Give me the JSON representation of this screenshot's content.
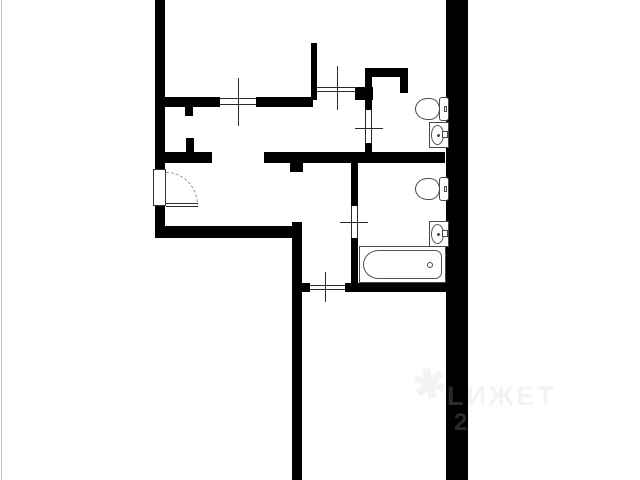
{
  "image": {
    "width": 640,
    "height": 480,
    "background": "#ffffff",
    "edge_line_color": "#c9c9c9"
  },
  "floorplan": {
    "wall_color": "#000000",
    "thin_line_color": "#2a2a2a",
    "fixture_outline_color": "#4a4a4a",
    "walls": [
      {
        "name": "left-wall-upper",
        "x": 155,
        "y": 0,
        "w": 10,
        "h": 170
      },
      {
        "name": "left-wall-lower",
        "x": 155,
        "y": 206,
        "w": 10,
        "h": 32
      },
      {
        "name": "living-room-bottom-wall",
        "x": 155,
        "y": 226,
        "w": 147,
        "h": 12
      },
      {
        "name": "corridor-wall",
        "x": 292,
        "y": 222,
        "w": 10,
        "h": 258
      },
      {
        "name": "corridor-wall-right-stub",
        "x": 302,
        "y": 283,
        "w": 8,
        "h": 9
      },
      {
        "name": "hall-wall-left-segment",
        "x": 165,
        "y": 152,
        "w": 47,
        "h": 11
      },
      {
        "name": "hall-wall-up-stub",
        "x": 186,
        "y": 138,
        "w": 8,
        "h": 14
      },
      {
        "name": "hall-wall-right-segment",
        "x": 264,
        "y": 152,
        "w": 181,
        "h": 11
      },
      {
        "name": "hall-wall-down-stub",
        "x": 290,
        "y": 163,
        "w": 13,
        "h": 9
      },
      {
        "name": "top-window-wall-left",
        "x": 165,
        "y": 97,
        "w": 55,
        "h": 10
      },
      {
        "name": "top-window-wall-right",
        "x": 256,
        "y": 97,
        "w": 57,
        "h": 10
      },
      {
        "name": "top-wall-down-stub",
        "x": 185,
        "y": 107,
        "w": 8,
        "h": 9
      },
      {
        "name": "upper-room-partition",
        "x": 311,
        "y": 43,
        "w": 6,
        "h": 57
      },
      {
        "name": "wc-corner-chunk",
        "x": 355,
        "y": 87,
        "w": 18,
        "h": 13
      },
      {
        "name": "wc-left-wall-upper",
        "x": 365,
        "y": 68,
        "w": 7,
        "h": 42
      },
      {
        "name": "wc-left-wall-lower",
        "x": 365,
        "y": 143,
        "w": 7,
        "h": 12
      },
      {
        "name": "wc-top-wall",
        "x": 365,
        "y": 68,
        "w": 43,
        "h": 9
      },
      {
        "name": "wc-duct-stub",
        "x": 400,
        "y": 77,
        "w": 8,
        "h": 16
      },
      {
        "name": "right-outer-wall",
        "x": 446,
        "y": 0,
        "w": 22,
        "h": 480
      },
      {
        "name": "bathroom-left-wall-upper",
        "x": 351,
        "y": 163,
        "w": 7,
        "h": 43
      },
      {
        "name": "bathroom-left-wall-lower",
        "x": 351,
        "y": 238,
        "w": 7,
        "h": 45
      },
      {
        "name": "bathroom-bottom-wall",
        "x": 345,
        "y": 283,
        "w": 101,
        "h": 9
      }
    ],
    "thin_lines": [
      {
        "name": "top-window-line-1",
        "x": 220,
        "y": 98,
        "w": 36,
        "h": 1
      },
      {
        "name": "top-window-line-2",
        "x": 220,
        "y": 104,
        "w": 36,
        "h": 1
      },
      {
        "name": "top-window-tick",
        "x": 238,
        "y": 78,
        "w": 1,
        "h": 48
      },
      {
        "name": "inner-window-line-1",
        "x": 317,
        "y": 87,
        "w": 40,
        "h": 1
      },
      {
        "name": "inner-window-line-2",
        "x": 317,
        "y": 91,
        "w": 40,
        "h": 1
      },
      {
        "name": "inner-window-tick",
        "x": 337,
        "y": 66,
        "w": 1,
        "h": 44
      },
      {
        "name": "wc-door-line-1",
        "x": 365,
        "y": 110,
        "w": 1,
        "h": 33
      },
      {
        "name": "wc-door-line-2",
        "x": 371,
        "y": 110,
        "w": 1,
        "h": 33
      },
      {
        "name": "wc-door-tick",
        "x": 355,
        "y": 128,
        "w": 28,
        "h": 1
      },
      {
        "name": "bathroom-door-line-1",
        "x": 351,
        "y": 206,
        "w": 1,
        "h": 32
      },
      {
        "name": "bathroom-door-line-2",
        "x": 357,
        "y": 206,
        "w": 1,
        "h": 32
      },
      {
        "name": "bathroom-door-tick",
        "x": 340,
        "y": 222,
        "w": 28,
        "h": 1
      },
      {
        "name": "bedroom-opening-line-1",
        "x": 310,
        "y": 285,
        "w": 35,
        "h": 1
      },
      {
        "name": "bedroom-opening-line-2",
        "x": 310,
        "y": 289,
        "w": 35,
        "h": 1
      },
      {
        "name": "bedroom-opening-tick",
        "x": 325,
        "y": 272,
        "w": 1,
        "h": 30
      },
      {
        "name": "entry-threshold-line-1",
        "x": 166,
        "y": 203,
        "w": 32,
        "h": 1
      },
      {
        "name": "entry-threshold-line-2",
        "x": 166,
        "y": 206,
        "w": 32,
        "h": 1
      }
    ],
    "entry_door": {
      "leaf": {
        "name": "entry-door-leaf",
        "x": 153,
        "y": 169,
        "w": 13,
        "h": 37
      },
      "arc": {
        "name": "entry-door-arc",
        "x": 166,
        "y": 172,
        "w": 32,
        "h": 33
      }
    },
    "fixtures": [
      {
        "type": "toilet",
        "name": "toilet-upper-bathroom",
        "x": 415,
        "y": 97,
        "w": 34,
        "h": 24
      },
      {
        "type": "sink",
        "name": "sink-upper-bathroom",
        "x": 429,
        "y": 122,
        "w": 20,
        "h": 26
      },
      {
        "type": "toilet",
        "name": "toilet-lower-bathroom",
        "x": 415,
        "y": 177,
        "w": 34,
        "h": 24
      },
      {
        "type": "sink",
        "name": "sink-lower-bathroom",
        "x": 429,
        "y": 221,
        "w": 20,
        "h": 26
      },
      {
        "type": "bathtub",
        "name": "bathtub",
        "x": 359,
        "y": 246,
        "w": 87,
        "h": 37
      }
    ]
  },
  "watermark": {
    "logo_glyph": "✱",
    "line1": "LИЖЕТ",
    "line2": "2"
  }
}
